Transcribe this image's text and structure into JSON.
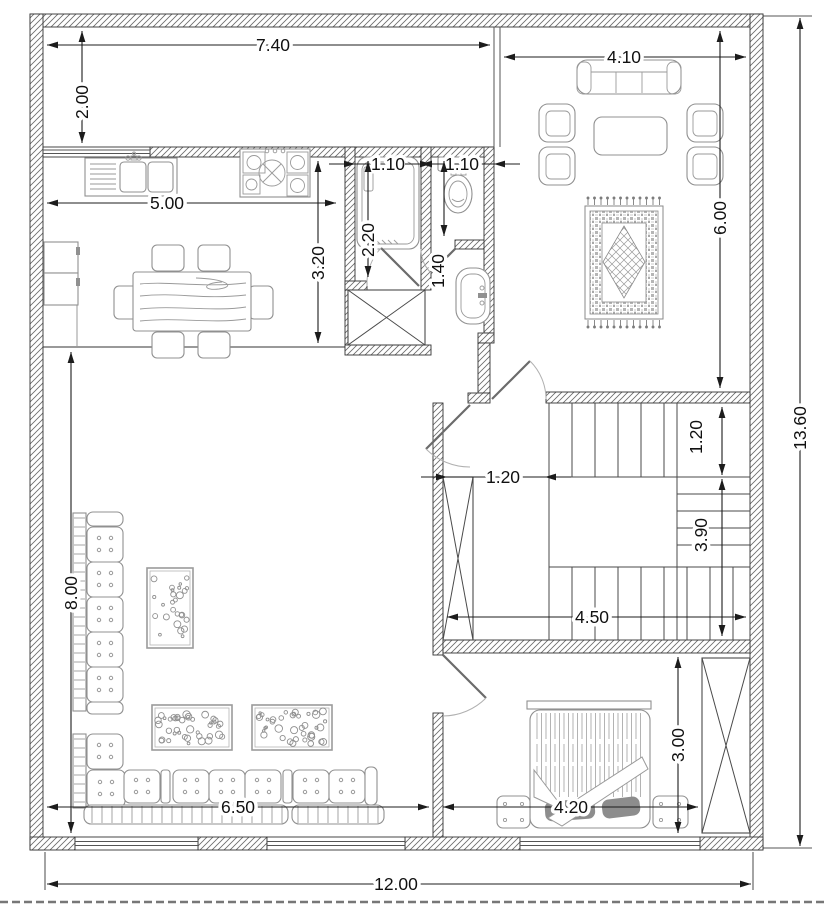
{
  "drawing": {
    "kind": "architectural-floor-plan",
    "units": "meters"
  },
  "colors": {
    "paper": "#ffffff",
    "wall_line": "#333333",
    "hatch_line": "#6a6a6a",
    "furniture_line": "#909090",
    "dimension_line": "#1c1c1c",
    "pillow_fill": "#8d8d8d",
    "boundary_dash": "#777777"
  },
  "dimensions": [
    {
      "id": "overall-width",
      "label": "12.00",
      "style": "out",
      "x1": 47,
      "y1": 884,
      "x2": 751,
      "y2": 884,
      "lx": 396,
      "ly": 884,
      "rot": false
    },
    {
      "id": "overall-height",
      "label": "13.60",
      "style": "out",
      "x1": 800,
      "y1": 18,
      "x2": 800,
      "y2": 846,
      "lx": 800,
      "ly": 428,
      "rot": true
    },
    {
      "id": "porch-width",
      "label": "7.40",
      "style": "out",
      "x1": 47,
      "y1": 45,
      "x2": 490,
      "y2": 45,
      "lx": 273,
      "ly": 45,
      "rot": false
    },
    {
      "id": "porch-depth",
      "label": "2.00",
      "style": "out",
      "x1": 82,
      "y1": 31,
      "x2": 82,
      "y2": 143,
      "lx": 82,
      "ly": 102,
      "rot": true
    },
    {
      "id": "living-width",
      "label": "4.10",
      "style": "out",
      "x1": 504,
      "y1": 57,
      "x2": 746,
      "y2": 57,
      "lx": 624,
      "ly": 57,
      "rot": false
    },
    {
      "id": "living-depth",
      "label": "6.00",
      "style": "out",
      "x1": 720,
      "y1": 31,
      "x2": 720,
      "y2": 388,
      "lx": 720,
      "ly": 218,
      "rot": true
    },
    {
      "id": "kitchen-width",
      "label": "5.00",
      "style": "out",
      "x1": 47,
      "y1": 203,
      "x2": 336,
      "y2": 203,
      "lx": 167,
      "ly": 203,
      "rot": false
    },
    {
      "id": "kitchen-depth",
      "label": "3.20",
      "style": "out",
      "x1": 318,
      "y1": 161,
      "x2": 318,
      "y2": 343,
      "lx": 318,
      "ly": 263,
      "rot": true
    },
    {
      "id": "bathroom-width",
      "label": "1.10",
      "style": "ext",
      "x1": 355,
      "y1": 164,
      "x2": 421,
      "y2": 164,
      "lx": 388,
      "ly": 164,
      "rot": false
    },
    {
      "id": "bathroom-depth",
      "label": "2.20",
      "style": "out",
      "x1": 368,
      "y1": 161,
      "x2": 368,
      "y2": 277,
      "lx": 368,
      "ly": 240,
      "rot": true
    },
    {
      "id": "wc-width",
      "label": "1.10",
      "style": "ext",
      "x1": 431,
      "y1": 164,
      "x2": 494,
      "y2": 164,
      "lx": 462,
      "ly": 164,
      "rot": false
    },
    {
      "id": "wc-depth",
      "label": "1.40",
      "style": "out",
      "x1": 444,
      "y1": 161,
      "x2": 444,
      "y2": 236,
      "lx": 438,
      "ly": 271,
      "rot": true
    },
    {
      "id": "corridor-width",
      "label": "1.20",
      "style": "ext",
      "x1": 447,
      "y1": 477,
      "x2": 545,
      "y2": 477,
      "lx": 503,
      "ly": 477,
      "rot": false
    },
    {
      "id": "stair-flight-width",
      "label": "1.20",
      "style": "out",
      "x1": 722,
      "y1": 407,
      "x2": 722,
      "y2": 475,
      "lx": 696,
      "ly": 437,
      "rot": true
    },
    {
      "id": "stair-run",
      "label": "3.90",
      "style": "out",
      "x1": 722,
      "y1": 479,
      "x2": 722,
      "y2": 636,
      "lx": 701,
      "ly": 535,
      "rot": true
    },
    {
      "id": "stair-hall-width",
      "label": "4.50",
      "style": "out",
      "x1": 447,
      "y1": 617,
      "x2": 746,
      "y2": 617,
      "lx": 592,
      "ly": 617,
      "rot": false
    },
    {
      "id": "majlis-depth",
      "label": "8.00",
      "style": "out",
      "x1": 71,
      "y1": 352,
      "x2": 71,
      "y2": 833,
      "lx": 71,
      "ly": 593,
      "rot": true
    },
    {
      "id": "majlis-width",
      "label": "6.50",
      "style": "out",
      "x1": 47,
      "y1": 807,
      "x2": 429,
      "y2": 807,
      "lx": 238,
      "ly": 807,
      "rot": false
    },
    {
      "id": "bedroom-depth",
      "label": "3.00",
      "style": "out",
      "x1": 678,
      "y1": 657,
      "x2": 678,
      "y2": 833,
      "lx": 678,
      "ly": 745,
      "rot": true
    },
    {
      "id": "bedroom-width",
      "label": "4.20",
      "style": "out",
      "x1": 443,
      "y1": 807,
      "x2": 698,
      "y2": 807,
      "lx": 571,
      "ly": 807,
      "rot": false
    }
  ],
  "furniture_items": [
    "kitchen-sink",
    "stove",
    "refrigerator",
    "dining-table",
    "dining-chairs",
    "bathtub",
    "toilet",
    "washbasin",
    "sofa-three-seat",
    "armchairs",
    "coffee-table",
    "living-room-rug",
    "staircase",
    "majlis-floor-sofa",
    "dotted-rugs",
    "bed",
    "nightstands",
    "wardrobe",
    "service-shafts"
  ],
  "rugs": {
    "majlis": [
      {
        "x": 147,
        "y": 568,
        "w": 46,
        "h": 80,
        "dots": 26
      },
      {
        "x": 152,
        "y": 705,
        "w": 80,
        "h": 45,
        "dots": 40
      },
      {
        "x": 252,
        "y": 705,
        "w": 80,
        "h": 45,
        "dots": 40
      }
    ]
  }
}
